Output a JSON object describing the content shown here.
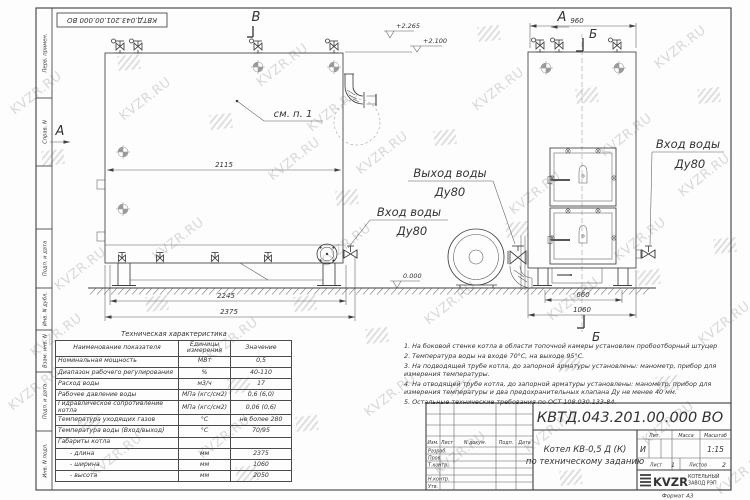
{
  "doc": {
    "number": "КВТД.043.201.00.000  ВО",
    "format": "Формат  А3"
  },
  "margin": {
    "cells": [
      "Перв. примен.",
      "Справ. N",
      "Подп. и дата",
      "Инв. N дубл.",
      "Взам. инв. N",
      "Подп. и дата",
      "Инв. N подл."
    ]
  },
  "views": {
    "a_left": "А",
    "a_top": "А",
    "v_top": "В",
    "b_top": "Б",
    "b_bottom": "Б",
    "see_note": "см. п. 1"
  },
  "elev": {
    "top1": "+2.265",
    "top2": "+2.100",
    "zero": "0.000"
  },
  "dims": {
    "boiler_inner": "2115",
    "boiler_base": "2245",
    "boiler_len": "2375",
    "front_top": "960",
    "front_feet": "660",
    "front_width": "1060"
  },
  "pipes": {
    "outlet_line1": "Выход воды",
    "outlet_line2": "Ду80",
    "inlet_line1": "Вход воды",
    "inlet_line2": "Ду80",
    "inlet2_line1": "Вход воды",
    "inlet2_line2": "Ду80"
  },
  "table": {
    "title": "Техническая характеристика",
    "headers": [
      "Наименование показателя",
      "Единицы измерения",
      "Значение"
    ],
    "rows": [
      [
        "Номинальная мощность",
        "МВт",
        "0,5"
      ],
      [
        "Диапазон рабочего регулирования",
        "%",
        "40-110"
      ],
      [
        "Расход воды",
        "м3/ч",
        "17"
      ],
      [
        "Рабочее давление воды",
        "МПа (кгс/см2)",
        "0,6 (6,0)"
      ],
      [
        "Гидравлическое сопротивление котла",
        "МПа (кгс/см2)",
        "0,06 (0,6)"
      ],
      [
        "Температура уходящих газов",
        "°С",
        "не более 280"
      ],
      [
        "Температура воды (Вход/выход)",
        "°С",
        "70/95"
      ],
      [
        "Габариты котла",
        "",
        ""
      ],
      [
        "- длина",
        "мм",
        "2375"
      ],
      [
        "- ширина",
        "мм",
        "1060"
      ],
      [
        "- высота",
        "мм",
        "2050"
      ]
    ]
  },
  "notes": {
    "items": [
      "1.  На боковой стенке котла в области топочной камеры установлен пробоотборный штуцер",
      "2.  Температура воды на входе 70°С, на выходе 95°С.",
      "3.  На подводящей трубе котла, до запорной арматуры установлены: манометр, прибор для измерения температуры.",
      "4.  На отводящей трубе котла, до запорной арматуры установлены: манометр, прибор для измерения температуры и два предохранительных клапана Ду не менее 40 мм.",
      "5.  Остальные технические требования по ОСТ 108.030.133-84."
    ]
  },
  "titleblock": {
    "doc_number": "КВТД.043.201.00.000  ВО",
    "title_line1": "Котел  КВ-0,5  Д  (К)",
    "title_line2": "по техническому заданию",
    "cols": [
      "Изм.",
      "Лист",
      "N докум.",
      "Подп.",
      "Дата"
    ],
    "rows": [
      "Разраб.",
      "Пров.",
      "Т.контр.",
      "Н.контр.",
      "Утв."
    ],
    "lit_label": "Лит.",
    "lit_value": "И",
    "mass_label": "Масса",
    "scale_label": "Масштаб",
    "scale_value": "1:15",
    "sheet_label": "Лист",
    "sheet_value": "1",
    "sheets_label": "Листов",
    "sheets_value": "2",
    "company": "KVZR",
    "company_sub1": "КОТЕЛЬНЫЙ",
    "company_sub2": "ЗАВОД РЭП"
  },
  "watermark": {
    "text": "KVZR.RU"
  }
}
